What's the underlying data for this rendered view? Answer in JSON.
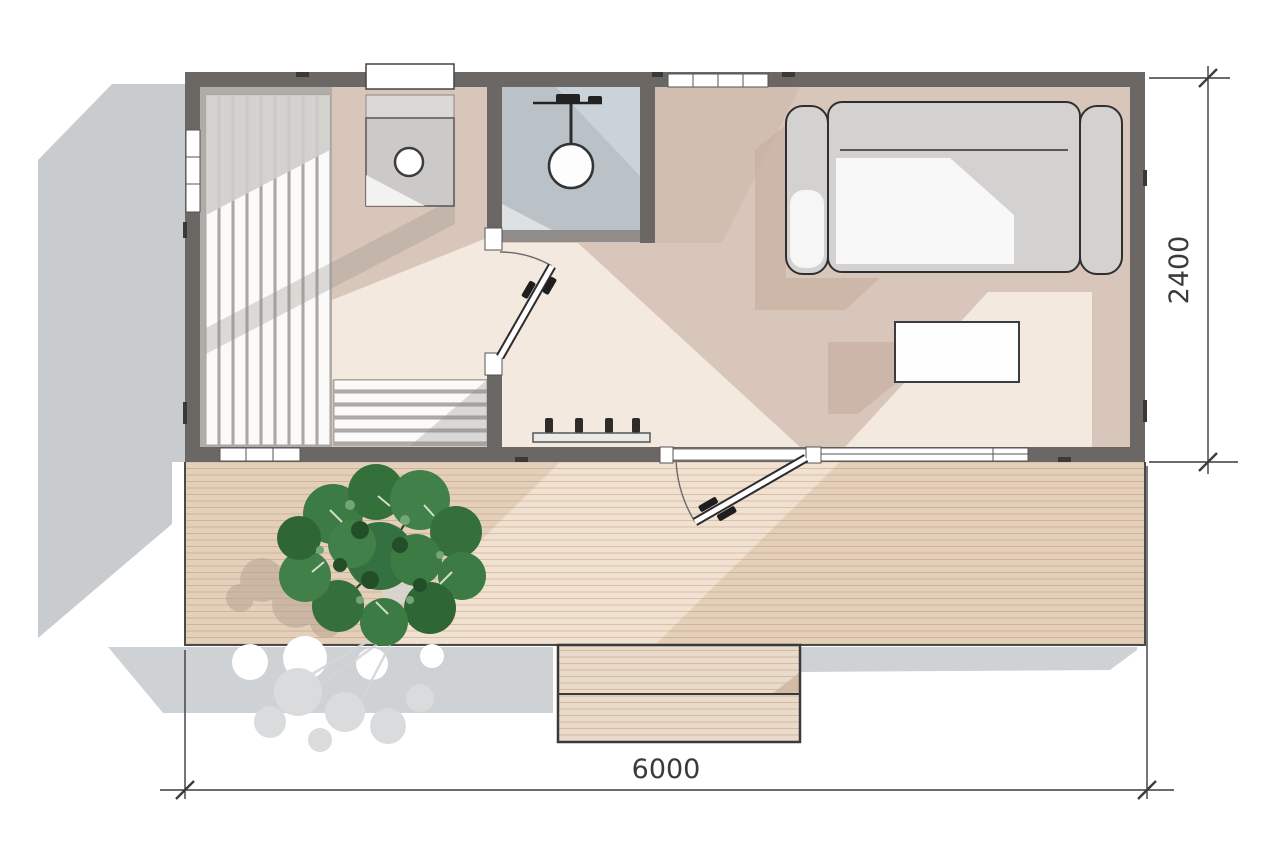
{
  "dimensions": {
    "width_mm": "6000",
    "height_mm": "2400"
  },
  "palette": {
    "background": "#ffffff",
    "wall": "#6b6764",
    "wall_partition_light": "#8f8c89",
    "cast_shadow": "#c9cccf",
    "floor_greige": "#d9c6ba",
    "floor_light": "#f4e9df",
    "bathroom_tile": "#bac2c8",
    "bathroom_tile_light": "#ccd3d8",
    "deck_base": "#f0e1d0",
    "deck_shaded": "#e2cdb6",
    "slat_white": "#fbfaf9",
    "slat_gap": "#b0aca8",
    "sofa_gray": "#d4d2d1",
    "counter_gray": "#cccac8",
    "plant_green": "#3c7b43",
    "plant_green_dark": "#2f6635",
    "dimension_ink": "#3a3a3a"
  }
}
